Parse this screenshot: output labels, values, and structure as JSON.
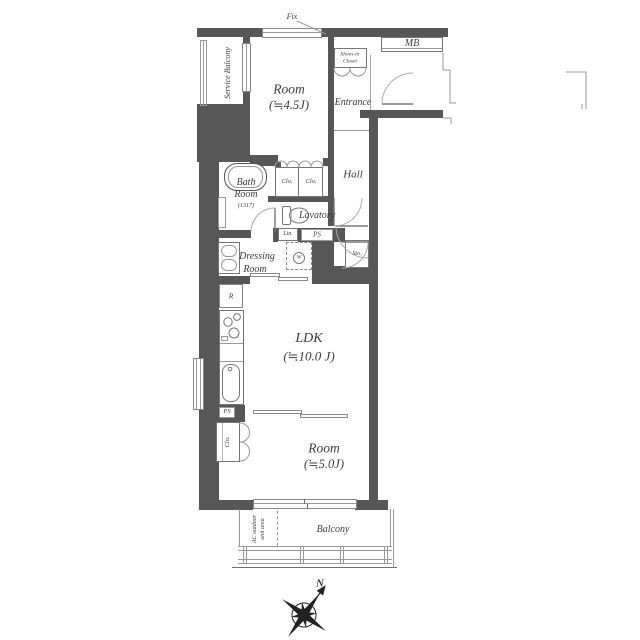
{
  "floorplan": {
    "rooms": {
      "room_top": {
        "label": "Room",
        "size": "(≒4.5J)"
      },
      "ldk": {
        "label": "LDK",
        "size": "(≒10.0 J)"
      },
      "room_bottom": {
        "label": "Room",
        "size": "(≒5.0J)"
      },
      "bath": {
        "label_line1": "Bath",
        "label_line2": "Room",
        "size": "(1317)"
      },
      "lavatory": {
        "label": "Lavatory"
      },
      "dressing_room": {
        "label_line1": "Dressing",
        "label_line2": "Room"
      },
      "hall": {
        "label": "Hall"
      },
      "entrance": {
        "label": "Entrance"
      },
      "balcony": {
        "label": "Balcony"
      },
      "service_balcony": {
        "label": "Service Balcony"
      },
      "ac_outdoor": {
        "label_line1": "AC outdoor",
        "label_line2": "unit area"
      }
    },
    "fixtures": {
      "fix_window": "Fix",
      "meter_box": "MB",
      "shoes_closet_line1": "Shoes-in",
      "shoes_closet_line2": "Closet",
      "closet_a": "Clo.",
      "closet_b": "Clo.",
      "closet_c": "Clo.",
      "linen": "Lin.",
      "pipe_space_mid": "PS",
      "pipe_space_kitchen": "PS",
      "storage": "Sto.",
      "washer": "W",
      "refrigerator": "R"
    },
    "compass": {
      "north": "N"
    },
    "colors": {
      "wall": "#575757",
      "line": "#9a9a9a",
      "text": "#3c3c3c"
    }
  }
}
